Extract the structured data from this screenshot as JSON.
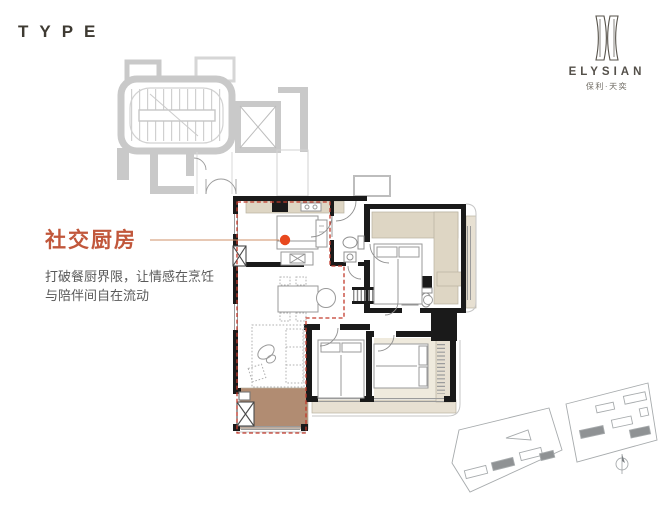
{
  "title_block": {
    "type_label": "TYPE"
  },
  "brand": {
    "logo_name": "ELYSIAN",
    "logo_subtitle": "保利·天奕"
  },
  "callout": {
    "title": "社交厨房",
    "description_lines": [
      "打破餐厨界限，让情感在烹饪",
      "与陪伴间自在流动"
    ]
  },
  "icons": {
    "emblem": "elysian-monogram",
    "marker": "orange-dot",
    "north_arrow": "compass-circle-needle"
  },
  "colors": {
    "accent_dot": "#e8481e",
    "callout_title": "#c1573b",
    "zone_dashed": "#c23b2c",
    "balcony_fill": "#b18c72",
    "cabinet_tan": "#ded6c4",
    "bay_tan": "#e7e0d2",
    "wall_black": "#1a1a1a",
    "core_gray": "#c9c9c9",
    "body_text": "#595959",
    "brand_text": "#54504a",
    "leader_line": "#cf9069",
    "site_gray": "#a7abad"
  }
}
